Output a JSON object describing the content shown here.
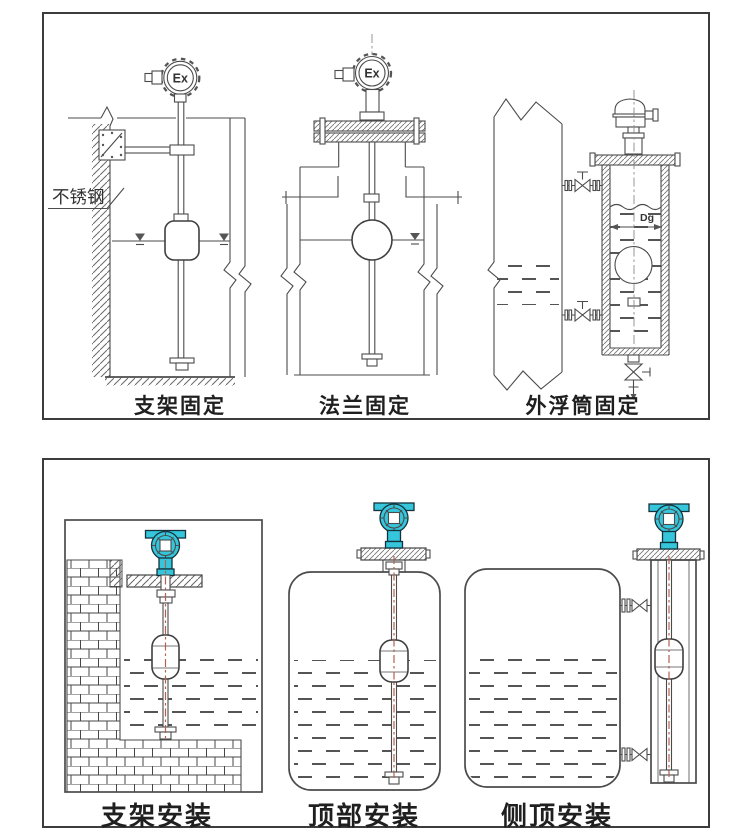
{
  "colors": {
    "line": "#4b4b4b",
    "panel_border": "#3c3c3c",
    "transmitter_teal": "#35c6dc",
    "centerline_red": "#b2604f",
    "label": "#1f1f1f"
  },
  "panels": {
    "top": {
      "diagrams": [
        {
          "caption": "支架固定",
          "head_label": "Ex",
          "material_label": "不锈钢"
        },
        {
          "caption": "法兰固定",
          "head_label": "Ex"
        },
        {
          "caption": "外浮筒固定",
          "dim_label": "Dg"
        }
      ]
    },
    "bottom": {
      "diagrams": [
        {
          "caption": "支架安装"
        },
        {
          "caption": "顶部安装"
        },
        {
          "caption": "侧顶安装"
        }
      ]
    }
  }
}
